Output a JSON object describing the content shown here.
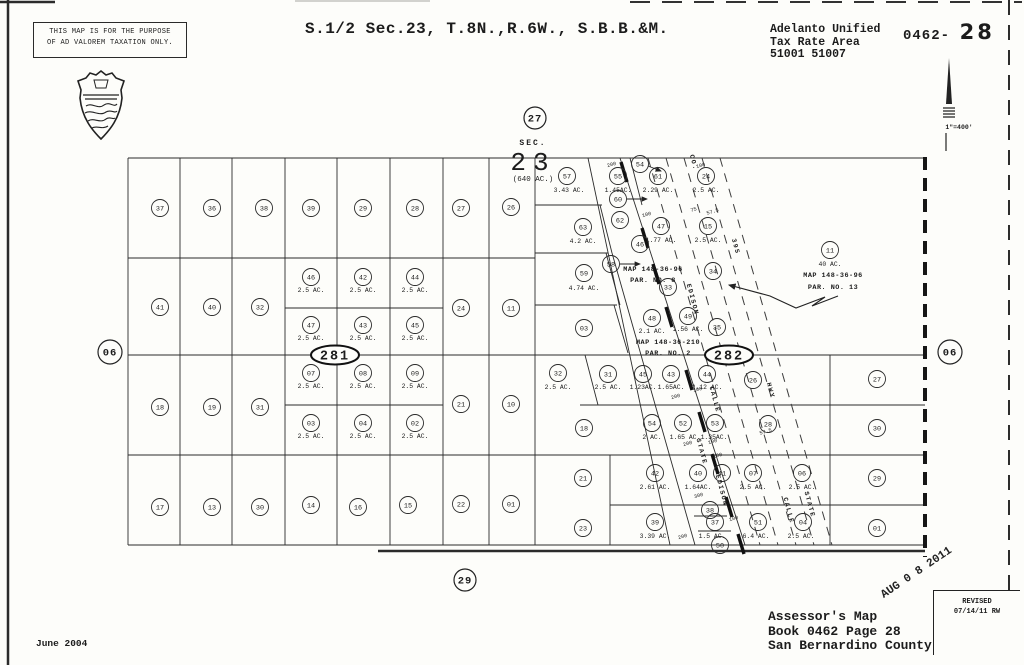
{
  "header": {
    "disclaimer_line1": "THIS MAP IS FOR THE PURPOSE",
    "disclaimer_line2": "OF AD VALOREM TAXATION ONLY.",
    "title": "S.1/2 Sec.23, T.8N.,R.6W., S.B.B.&M.",
    "district": "Adelanto Unified",
    "tax_area_label": "Tax Rate Area",
    "tax_codes": "51001 51007",
    "book_prefix": "0462-",
    "page_big": "28",
    "scale_label": "1\"=400'"
  },
  "footer": {
    "map_line1": "Assessor's Map",
    "map_line2": "Book 0462 Page 28",
    "map_line3": "San Bernardino County",
    "date": "June 2004",
    "stamp": "AUG 0 8 2011",
    "revised_label": "REVISED",
    "revised_date": "07/14/11 RW"
  },
  "map": {
    "sec_block": {
      "sec": "SEC.",
      "num": "23",
      "acres": "(640 AC.)",
      "x": 533,
      "y_sec": 145,
      "y_num": 170,
      "y_ac": 181
    },
    "ring_labels": [
      {
        "t": "27",
        "x": 535,
        "y": 118,
        "r": 11
      },
      {
        "t": "29",
        "x": 465,
        "y": 580,
        "r": 11
      },
      {
        "t": "06",
        "x": 110,
        "y": 352,
        "r": 12
      },
      {
        "t": "06",
        "x": 950,
        "y": 352,
        "r": 12
      }
    ],
    "block_ovals": [
      {
        "t": "281",
        "x": 335,
        "y": 355,
        "rx": 24,
        "ry": 9.5
      },
      {
        "t": "282",
        "x": 729,
        "y": 355,
        "rx": 24,
        "ry": 9.5
      }
    ],
    "parcels": [
      {
        "n": "37",
        "x": 160,
        "y": 208
      },
      {
        "n": "36",
        "x": 212,
        "y": 208
      },
      {
        "n": "38",
        "x": 264,
        "y": 208
      },
      {
        "n": "39",
        "x": 311,
        "y": 208
      },
      {
        "n": "29",
        "x": 363,
        "y": 208
      },
      {
        "n": "28",
        "x": 415,
        "y": 208
      },
      {
        "n": "27",
        "x": 461,
        "y": 208
      },
      {
        "n": "26",
        "x": 511,
        "y": 207
      },
      {
        "n": "41",
        "x": 160,
        "y": 307
      },
      {
        "n": "40",
        "x": 212,
        "y": 307
      },
      {
        "n": "32",
        "x": 260,
        "y": 307
      },
      {
        "n": "24",
        "x": 461,
        "y": 308
      },
      {
        "n": "11",
        "x": 511,
        "y": 308
      },
      {
        "n": "46",
        "x": 311,
        "y": 277,
        "ac": "2.5 AC.",
        "ax": 311,
        "ay": 290
      },
      {
        "n": "42",
        "x": 363,
        "y": 277,
        "ac": "2.5 AC.",
        "ax": 363,
        "ay": 290
      },
      {
        "n": "44",
        "x": 415,
        "y": 277,
        "ac": "2.5 AC.",
        "ax": 415,
        "ay": 290
      },
      {
        "n": "47",
        "x": 311,
        "y": 325,
        "ac": "2.5 AC.",
        "ax": 311,
        "ay": 338
      },
      {
        "n": "43",
        "x": 363,
        "y": 325,
        "ac": "2.5 AC.",
        "ax": 363,
        "ay": 338
      },
      {
        "n": "45",
        "x": 415,
        "y": 325,
        "ac": "2.5 AC.",
        "ax": 415,
        "ay": 338
      },
      {
        "n": "18",
        "x": 160,
        "y": 407
      },
      {
        "n": "19",
        "x": 212,
        "y": 407
      },
      {
        "n": "31",
        "x": 260,
        "y": 407
      },
      {
        "n": "21",
        "x": 461,
        "y": 404
      },
      {
        "n": "10",
        "x": 511,
        "y": 404
      },
      {
        "n": "07",
        "x": 311,
        "y": 373,
        "ac": "2.5 AC.",
        "ax": 311,
        "ay": 386
      },
      {
        "n": "08",
        "x": 363,
        "y": 373,
        "ac": "2.5 AC.",
        "ax": 363,
        "ay": 386
      },
      {
        "n": "09",
        "x": 415,
        "y": 373,
        "ac": "2.5 AC.",
        "ax": 415,
        "ay": 386
      },
      {
        "n": "03",
        "x": 311,
        "y": 423,
        "ac": "2.5 AC.",
        "ax": 311,
        "ay": 436
      },
      {
        "n": "04",
        "x": 363,
        "y": 423,
        "ac": "2.5 AC.",
        "ax": 363,
        "ay": 436
      },
      {
        "n": "02",
        "x": 415,
        "y": 423,
        "ac": "2.5 AC.",
        "ax": 415,
        "ay": 436
      },
      {
        "n": "17",
        "x": 160,
        "y": 507
      },
      {
        "n": "13",
        "x": 212,
        "y": 507
      },
      {
        "n": "30",
        "x": 260,
        "y": 507
      },
      {
        "n": "14",
        "x": 311,
        "y": 505
      },
      {
        "n": "16",
        "x": 358,
        "y": 507
      },
      {
        "n": "15",
        "x": 408,
        "y": 505
      },
      {
        "n": "22",
        "x": 461,
        "y": 504
      },
      {
        "n": "01",
        "x": 511,
        "y": 504
      },
      {
        "n": "57",
        "x": 567,
        "y": 176,
        "ac": "3.43 AC.",
        "ax": 569,
        "ay": 190
      },
      {
        "n": "63",
        "x": 583,
        "y": 227,
        "ac": "4.2 AC.",
        "ax": 583,
        "ay": 241
      },
      {
        "n": "59",
        "x": 584,
        "y": 273,
        "ac": "4.74 AC.",
        "ax": 584,
        "ay": 288
      },
      {
        "n": "03",
        "x": 584,
        "y": 328
      },
      {
        "n": "32",
        "x": 558,
        "y": 373,
        "ac": "2.5 AC.",
        "ax": 558,
        "ay": 387
      },
      {
        "n": "18",
        "x": 584,
        "y": 428
      },
      {
        "n": "21",
        "x": 583,
        "y": 478
      },
      {
        "n": "23",
        "x": 583,
        "y": 528
      },
      {
        "n": "55",
        "x": 618,
        "y": 176,
        "ac": "1.45AC.",
        "ax": 618,
        "ay": 190
      },
      {
        "n": "54",
        "x": 640,
        "y": 164
      },
      {
        "n": "61",
        "x": 658,
        "y": 176,
        "ac": "2.29 AC.",
        "ax": 658,
        "ay": 190
      },
      {
        "n": "24",
        "x": 706,
        "y": 176,
        "ac": "2.5 AC.",
        "ax": 706,
        "ay": 190
      },
      {
        "n": "60",
        "x": 618,
        "y": 199
      },
      {
        "n": "62",
        "x": 620,
        "y": 220
      },
      {
        "n": "47",
        "x": 661,
        "y": 226,
        "ac": "1.77 AC.",
        "ax": 661,
        "ay": 240
      },
      {
        "n": "15",
        "x": 708,
        "y": 226,
        "ac": "2.5 AC.",
        "ax": 708,
        "ay": 240
      },
      {
        "n": "46",
        "x": 640,
        "y": 244
      },
      {
        "n": "58",
        "x": 611,
        "y": 264
      },
      {
        "n": "34",
        "x": 713,
        "y": 271
      },
      {
        "n": "33",
        "x": 668,
        "y": 287
      },
      {
        "n": "48",
        "x": 652,
        "y": 318,
        "ac": "2.1 AC.",
        "ax": 652,
        "ay": 331
      },
      {
        "n": "49",
        "x": 688,
        "y": 316,
        "ac": "1.56 AC.",
        "ax": 688,
        "ay": 329
      },
      {
        "n": "35",
        "x": 717,
        "y": 327
      },
      {
        "n": "31",
        "x": 608,
        "y": 374,
        "ac": "2.5 AC.",
        "ax": 608,
        "ay": 387
      },
      {
        "n": "45",
        "x": 643,
        "y": 374,
        "ac": "1.23AC.",
        "ax": 643,
        "ay": 387
      },
      {
        "n": "43",
        "x": 671,
        "y": 374,
        "ac": "1.65AC.",
        "ax": 671,
        "ay": 387
      },
      {
        "n": "44",
        "x": 707,
        "y": 374,
        "ac": "2.12 AC.",
        "ax": 707,
        "ay": 387
      },
      {
        "n": "26",
        "x": 753,
        "y": 380
      },
      {
        "n": "54",
        "x": 652,
        "y": 423,
        "ac": "2 AC.",
        "ax": 652,
        "ay": 437
      },
      {
        "n": "52",
        "x": 683,
        "y": 423,
        "ac": "1.65 AC.",
        "ax": 685,
        "ay": 437
      },
      {
        "n": "53",
        "x": 715,
        "y": 423,
        "ac": "1.35AC.",
        "ax": 714,
        "ay": 437
      },
      {
        "n": "28",
        "x": 768,
        "y": 424
      },
      {
        "n": "42",
        "x": 655,
        "y": 473,
        "ac": "2.61 AC.",
        "ax": 655,
        "ay": 487
      },
      {
        "n": "40",
        "x": 698,
        "y": 473,
        "ac": "1.64AC.",
        "ax": 698,
        "ay": 487
      },
      {
        "n": "41",
        "x": 722,
        "y": 473
      },
      {
        "n": "07",
        "x": 753,
        "y": 473,
        "ac": "2.5 AC.",
        "ax": 753,
        "ay": 487
      },
      {
        "n": "06",
        "x": 802,
        "y": 473,
        "ac": "2.5 AC.",
        "ax": 802,
        "ay": 487
      },
      {
        "n": "39",
        "x": 655,
        "y": 522,
        "ac": "3.39 AC.",
        "ax": 655,
        "ay": 536
      },
      {
        "n": "38",
        "x": 710,
        "y": 510
      },
      {
        "n": "37",
        "x": 715,
        "y": 522,
        "ac": "1.5 AC.",
        "ax": 712,
        "ay": 536
      },
      {
        "n": "50",
        "x": 720,
        "y": 545
      },
      {
        "n": "51",
        "x": 758,
        "y": 522,
        "ac": "6.4 AC.",
        "ax": 756,
        "ay": 536
      },
      {
        "n": "04",
        "x": 803,
        "y": 522,
        "ac": "2.5 AC.",
        "ax": 801,
        "ay": 536
      },
      {
        "n": "11",
        "x": 830,
        "y": 250,
        "ac": "40 AC.",
        "ax": 830,
        "ay": 264
      },
      {
        "n": "27",
        "x": 877,
        "y": 379
      },
      {
        "n": "30",
        "x": 877,
        "y": 428
      },
      {
        "n": "29",
        "x": 877,
        "y": 478
      },
      {
        "n": "01",
        "x": 877,
        "y": 528
      }
    ],
    "map_refs": [
      {
        "l1": "MAP 148-36-96",
        "l2": "PAR. NO. 8",
        "x": 653,
        "y1": 271,
        "y2": 282
      },
      {
        "l1": "MAP 148-36-210",
        "l2": "PAR. NO. 2",
        "x": 668,
        "y1": 344,
        "y2": 355
      },
      {
        "l1": "MAP 148-36-96",
        "l2": "PAR. NO. 13",
        "x": 833,
        "y1": 277,
        "y2": 289
      }
    ],
    "road_labels": [
      {
        "t": "CO.",
        "x": 692,
        "y": 163
      },
      {
        "t": "395",
        "x": 734,
        "y": 247
      },
      {
        "t": "EDISON",
        "x": 691,
        "y": 300
      },
      {
        "t": "CALLE",
        "x": 713,
        "y": 400
      },
      {
        "t": "HWY",
        "x": 769,
        "y": 391
      },
      {
        "t": "STATE",
        "x": 700,
        "y": 452
      },
      {
        "t": "EDISON",
        "x": 720,
        "y": 491
      },
      {
        "t": "CALLE",
        "x": 787,
        "y": 511
      },
      {
        "t": "STATE",
        "x": 808,
        "y": 505
      }
    ],
    "dim_labels": [
      {
        "t": "200",
        "x": 612,
        "y": 166
      },
      {
        "t": "100",
        "x": 701,
        "y": 167
      },
      {
        "t": "75",
        "x": 694,
        "y": 211
      },
      {
        "t": "57.5",
        "x": 713,
        "y": 213
      },
      {
        "t": "100",
        "x": 647,
        "y": 216
      },
      {
        "t": "57.5",
        "x": 766,
        "y": 433
      },
      {
        "t": "200",
        "x": 676,
        "y": 398
      },
      {
        "t": "100",
        "x": 698,
        "y": 391
      },
      {
        "t": "200",
        "x": 688,
        "y": 445
      },
      {
        "t": "100",
        "x": 713,
        "y": 443
      },
      {
        "t": "100",
        "x": 718,
        "y": 457
      },
      {
        "t": "300",
        "x": 699,
        "y": 497
      },
      {
        "t": "100",
        "x": 734,
        "y": 520
      },
      {
        "t": "200",
        "x": 683,
        "y": 538
      }
    ],
    "lines": {
      "thin": [
        [
          128,
          158,
          925,
          158
        ],
        [
          128,
          258,
          535,
          258
        ],
        [
          285,
          308,
          443,
          308
        ],
        [
          128,
          355,
          925,
          355
        ],
        [
          285,
          405,
          443,
          405
        ],
        [
          580,
          405,
          925,
          405
        ],
        [
          128,
          455,
          925,
          455
        ],
        [
          610,
          505,
          925,
          505
        ],
        [
          128,
          545,
          925,
          545
        ],
        [
          535,
          205,
          602,
          205
        ],
        [
          535,
          253,
          608,
          253
        ],
        [
          535,
          305,
          617,
          305
        ],
        [
          128,
          158,
          128,
          545
        ],
        [
          180,
          158,
          180,
          545
        ],
        [
          232,
          158,
          232,
          545
        ],
        [
          285,
          158,
          285,
          545
        ],
        [
          337,
          158,
          337,
          545
        ],
        [
          390,
          158,
          390,
          545
        ],
        [
          443,
          158,
          443,
          545
        ],
        [
          489,
          158,
          489,
          545
        ],
        [
          535,
          158,
          535,
          545
        ],
        [
          610,
          455,
          610,
          545
        ],
        [
          830,
          355,
          830,
          545
        ],
        [
          588,
          158,
          670,
          545
        ],
        [
          612,
          253,
          695,
          545
        ],
        [
          620,
          158,
          745,
          545
        ],
        [
          630,
          158,
          642,
          205
        ],
        [
          600,
          205,
          612,
          253
        ],
        [
          606,
          253,
          620,
          305
        ],
        [
          614,
          305,
          628,
          353
        ],
        [
          585,
          355,
          598,
          405
        ],
        [
          694,
          516,
          727,
          516
        ],
        [
          698,
          531,
          731,
          531
        ]
      ],
      "bold": [
        [
          378,
          551,
          925,
          551
        ],
        [
          0,
          2,
          55,
          2
        ]
      ],
      "ticks": [
        [
          621,
          162,
          627,
          182
        ],
        [
          642,
          228,
          648,
          248
        ],
        [
          653,
          264,
          659,
          284
        ],
        [
          666,
          307,
          672,
          327
        ],
        [
          686,
          370,
          692,
          390
        ],
        [
          699,
          412,
          705,
          432
        ],
        [
          712,
          454,
          718,
          474
        ],
        [
          726,
          497,
          732,
          517
        ],
        [
          738,
          534,
          744,
          554
        ]
      ],
      "road_dash": [
        [
          648,
          158,
          760,
          545
        ],
        [
          666,
          158,
          778,
          545
        ],
        [
          684,
          158,
          796,
          545
        ],
        [
          702,
          158,
          814,
          545
        ],
        [
          720,
          158,
          832,
          545
        ]
      ],
      "bold_dash": [
        {
          "p": [
            925,
            157,
            925,
            557
          ],
          "w": 4,
          "d": "13 8"
        },
        {
          "p": [
            1009,
            0,
            1009,
            597
          ],
          "w": 1.8,
          "d": "15 10"
        },
        {
          "p": [
            630,
            2,
            1022,
            2
          ],
          "w": 1.8,
          "d": "20 12"
        }
      ],
      "border_left": [
        8,
        0,
        8,
        665
      ],
      "scan_mark": [
        295,
        1,
        430,
        1
      ]
    },
    "arrows": [
      {
        "x1": 627,
        "y1": 199,
        "x2": 647,
        "y2": 199
      },
      {
        "x1": 620,
        "y1": 264,
        "x2": 640,
        "y2": 264
      },
      {
        "x1": 648,
        "y1": 166,
        "x2": 661,
        "y2": 171
      }
    ],
    "squiggle": "838,296 812,306 825,297 796,308 770,296 729,285"
  }
}
